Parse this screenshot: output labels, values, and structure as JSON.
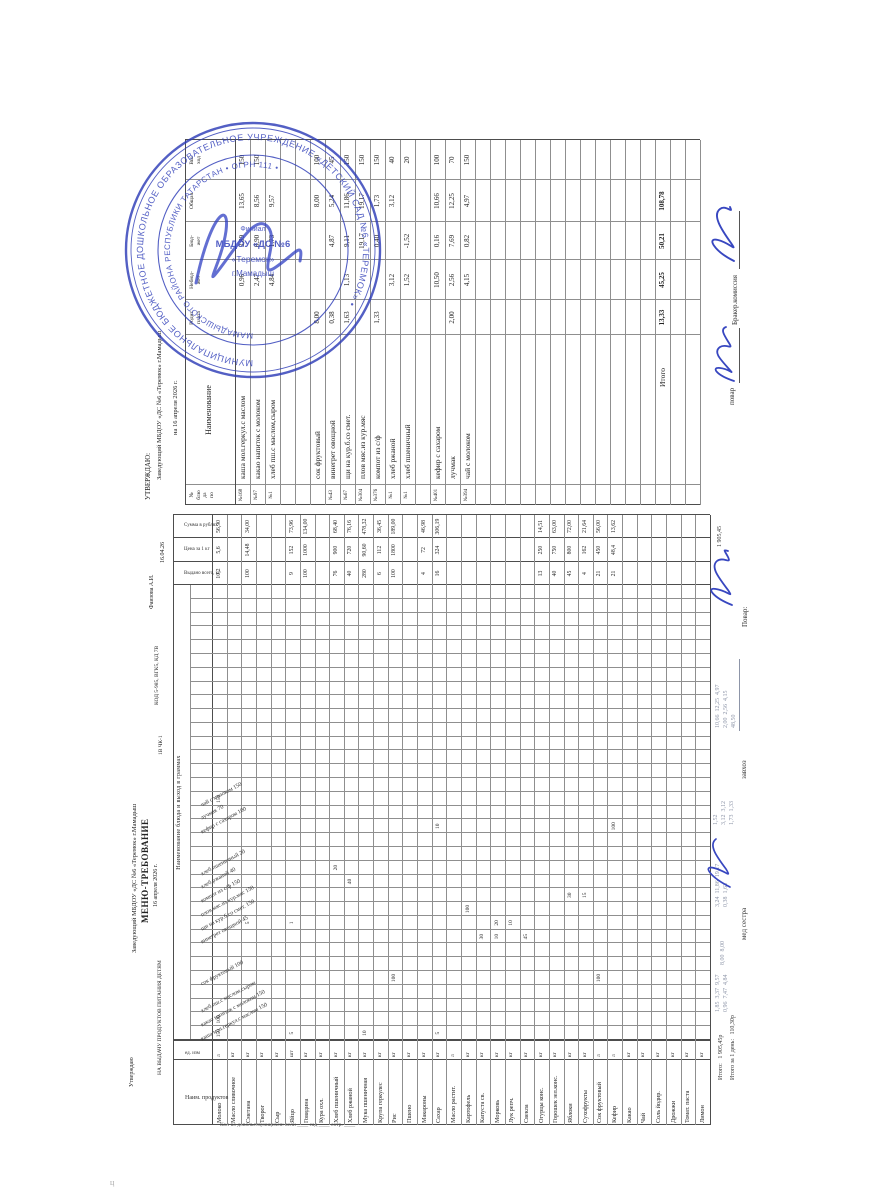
{
  "top_page": {
    "approve_title": "УТВЕРЖДАЮ:",
    "approve_org": "Заведующий МБДОУ «ДС №6 «Теремок» г.Мамадыш",
    "approve_date": "на 16 апреля 2026 г.",
    "table": {
      "headers": {
        "num": "№\nблю\nда\nпо",
        "name": "Наименование",
        "c1": "Родит.\nплата",
        "c2": "Небюд-\nжет",
        "c3": "Бюд-\nжет",
        "c4": "Общая",
        "out": "Вы-\nход"
      },
      "rows": [
        {
          "r": 1,
          "no": "№168",
          "name": "каша мол.геркул.с маслом",
          "c1": "",
          "c2": "0,96",
          "c3": "3,89",
          "c4": "13,65",
          "out": "150"
        },
        {
          "r": 2,
          "no": "№97",
          "name": "какао напиток с молоком",
          "c1": "",
          "c2": "2,47",
          "c3": "0,90",
          "c4": "8,56",
          "out": "150"
        },
        {
          "r": 3,
          "no": "№1",
          "name": "хлеб пш.с маслом,сыром",
          "c1": "",
          "c2": "4,84",
          "c3": "1,73",
          "c4": "9,57",
          "out": ""
        },
        {
          "r": 6,
          "no": "",
          "name": "сок фруктовый",
          "c1": "8,00",
          "c2": "",
          "c3": "",
          "c4": "8,00",
          "out": "100"
        },
        {
          "r": 7,
          "no": "№43",
          "name": "винегрет овощной",
          "c1": "0,38",
          "c2": "",
          "c3": "4,87",
          "c4": "5,24",
          "out": "45"
        },
        {
          "r": 8,
          "no": "№67",
          "name": "щи на кур.б.со смет.",
          "c1": "1,63",
          "c2": "1,13",
          "c3": "9,11",
          "c4": "11,86",
          "out": "150"
        },
        {
          "r": 9,
          "no": "№304",
          "name": "плов мяс.из кур.мяс",
          "c1": "",
          "c2": "",
          "c3": "19,17",
          "c4": "19,17",
          "out": "150"
        },
        {
          "r": 10,
          "no": "№376",
          "name": "компот из с/ф",
          "c1": "1,33",
          "c2": "",
          "c3": "0,40",
          "c4": "1,73",
          "out": "150"
        },
        {
          "r": 11,
          "no": "№1",
          "name": "хлеб ржаной",
          "c1": "",
          "c2": "3,12",
          "c3": "",
          "c4": "3,12",
          "out": "40"
        },
        {
          "r": 12,
          "no": "№1",
          "name": "хлеб пшеничный",
          "c1": "",
          "c2": "1,52",
          "c3": "-1,52",
          "c4": "",
          "out": "20"
        },
        {
          "r": 14,
          "no": "№401",
          "name": "кефир с сахаром",
          "c1": "",
          "c2": "10,50",
          "c3": "0,16",
          "c4": "10,66",
          "out": "100"
        },
        {
          "r": 15,
          "no": "",
          "name": "лучмак",
          "c1": "2,00",
          "c2": "2,56",
          "c3": "7,69",
          "c4": "12,25",
          "out": "70"
        },
        {
          "r": 16,
          "no": "№394",
          "name": "чай с молоком",
          "c1": "",
          "c2": "4,15",
          "c3": "0,82",
          "c4": "4,97",
          "out": "150"
        }
      ],
      "total": {
        "label": "Итого",
        "c1": "13,33",
        "c2": "45,25",
        "c3": "50,21",
        "c4": "108,78"
      }
    },
    "footer": {
      "cook_label": "повар",
      "commission_label": "Бракер.комиссия"
    }
  },
  "stamp": {
    "outer_ring": "МУНИЦИПАЛЬНОЕ БЮДЖЕТНОЕ ДОШКОЛЬНОЕ ОБРАЗОВАТЕЛЬНОЕ УЧРЕЖДЕНИЕ «ДЕТСКИЙ САД №6 «ТЕРЕМОК» • ",
    "inner_ring": "МАМАДЫШСКОГО РАЙОНА РЕСПУБЛИКИ ТАТАРСТАН • ОГРН 111 • ",
    "center_lines": [
      "Филиал",
      "МБДОУ «ДС №6",
      "«Теремок»",
      "г.Мамадыш"
    ],
    "color": "#2e3db8"
  },
  "bottom_page": {
    "header": {
      "approve": "Утверждаю",
      "org": "Заведующий МБДОУ «ДС №6 «Теремок» г.Мамадыш",
      "title": "МЕНЮ-ТРЕБОВАНИЕ",
      "date": "16 апреля 2026 г.",
      "subtitle": "НА ВЫДАЧУ ПРОДУКТОВ ПИТАНИЯ ДЕТЯМ",
      "codes": "КОД 5-985, ВГК5, КД 7В",
      "codes2": "1В ЧК-1",
      "person": "Фаизова А.И.",
      "date_short": "16.04.26"
    },
    "margin_note": "Кол-во довольствующихся: ясли ____  сад ____  сотр. ____",
    "table": {
      "group_header": "Наименование блюда и выход в граммах",
      "products_header": "Наим. продуктов",
      "unit_header": "ед. изм",
      "given_header": "Выдано всего, кг",
      "price_header": "Цена за 1 кг",
      "sum_header": "Сумма в рублях",
      "dishes": [
        {
          "col": 0,
          "label": "каша мол.геркул.с маслом 150"
        },
        {
          "col": 1,
          "label": "какао напиток с молоком 150"
        },
        {
          "col": 2,
          "label": "хлеб пш.с маслом,сыром"
        },
        {
          "col": 4,
          "label": "сок фруктовый 100"
        },
        {
          "col": 7,
          "label": "винегрет овощной 45"
        },
        {
          "col": 8,
          "label": "щи на кур.б.со смет. 150"
        },
        {
          "col": 9,
          "label": "плов мяс.из кур.мяс 150"
        },
        {
          "col": 10,
          "label": "компот из с/ф 150"
        },
        {
          "col": 11,
          "label": "хлеб ржаной 40"
        },
        {
          "col": 12,
          "label": "хлеб пшеничный 20"
        },
        {
          "col": 15,
          "label": "кефир с сахаром 100"
        },
        {
          "col": 16,
          "label": "лучмак 70"
        },
        {
          "col": 17,
          "label": "чай с молоком 150"
        }
      ],
      "products": [
        {
          "name": "Молоко",
          "unit": "л",
          "given": "10,2",
          "price": "5,6",
          "sum": "56,90"
        },
        {
          "name": "Масло сливочное",
          "unit": "кг",
          "given": "",
          "price": "",
          "sum": ""
        },
        {
          "name": "Сметана",
          "unit": "кг",
          "given": "100",
          "price": "14,48",
          "sum": "34,00"
        },
        {
          "name": "Творог",
          "unit": "кг",
          "given": "",
          "price": "",
          "sum": ""
        },
        {
          "name": "Сыр",
          "unit": "кг",
          "given": "",
          "price": "",
          "sum": ""
        },
        {
          "name": "Яйцо",
          "unit": "шт",
          "given": "9",
          "price": "152",
          "sum": "73,96"
        },
        {
          "name": "Говядина",
          "unit": "кг",
          "given": "100",
          "price": "1000",
          "sum": "134,00"
        },
        {
          "name": "Кура охл.",
          "unit": "кг",
          "given": "",
          "price": "",
          "sum": ""
        },
        {
          "name": "Хлеб пшеничный",
          "unit": "кг",
          "given": "76",
          "price": "900",
          "sum": "68,40"
        },
        {
          "name": "Хлеб ржаной",
          "unit": "кг",
          "given": "40",
          "price": "720",
          "sum": "76,16"
        },
        {
          "name": "Мука пшеничная",
          "unit": "кг",
          "given": "280",
          "price": "90,60",
          "sum": "478,32"
        },
        {
          "name": "Крупа геркулес",
          "unit": "кг",
          "given": "6",
          "price": "112",
          "sum": "36,45"
        },
        {
          "name": "Рис",
          "unit": "кг",
          "given": "100",
          "price": "1800",
          "sum": "189,00"
        },
        {
          "name": "Пшено",
          "unit": "кг",
          "given": "",
          "price": "",
          "sum": ""
        },
        {
          "name": "Макароны",
          "unit": "кг",
          "given": "4",
          "price": "72",
          "sum": "46,98"
        },
        {
          "name": "Сахар",
          "unit": "кг",
          "given": "16",
          "price": "324",
          "sum": "306,19"
        },
        {
          "name": "Масло растит.",
          "unit": "л",
          "given": "",
          "price": "",
          "sum": ""
        },
        {
          "name": "Картофель",
          "unit": "кг",
          "given": "",
          "price": "",
          "sum": ""
        },
        {
          "name": "Капуста св.",
          "unit": "кг",
          "given": "",
          "price": "",
          "sum": ""
        },
        {
          "name": "Морковь",
          "unit": "кг",
          "given": "",
          "price": "",
          "sum": ""
        },
        {
          "name": "Лук репч.",
          "unit": "кг",
          "given": "",
          "price": "",
          "sum": ""
        },
        {
          "name": "Свекла",
          "unit": "кг",
          "given": "",
          "price": "",
          "sum": ""
        },
        {
          "name": "Огурцы конс.",
          "unit": "кг",
          "given": "13",
          "price": "250",
          "sum": "14,51"
        },
        {
          "name": "Горошек зел.конс.",
          "unit": "кг",
          "given": "40",
          "price": "750",
          "sum": "63,00"
        },
        {
          "name": "Яблоки",
          "unit": "кг",
          "given": "45",
          "price": "800",
          "sum": "72,00"
        },
        {
          "name": "Сухофрукты",
          "unit": "кг",
          "given": "4",
          "price": "162",
          "sum": "21,64"
        },
        {
          "name": "Сок фруктовый",
          "unit": "л",
          "given": "21",
          "price": "450",
          "sum": "56,00"
        },
        {
          "name": "Кефир",
          "unit": "л",
          "given": "21",
          "price": "48,4",
          "sum": "13,62"
        },
        {
          "name": "Какао",
          "unit": "кг",
          "given": "",
          "price": "",
          "sum": ""
        },
        {
          "name": "Чай",
          "unit": "кг",
          "given": "",
          "price": "",
          "sum": ""
        },
        {
          "name": "Соль йодир.",
          "unit": "кг",
          "given": "",
          "price": "",
          "sum": ""
        },
        {
          "name": "Дрожжи",
          "unit": "кг",
          "given": "",
          "price": "",
          "sum": ""
        },
        {
          "name": "Томат. паста",
          "unit": "кг",
          "given": "",
          "price": "",
          "sum": ""
        },
        {
          "name": "Лимон",
          "unit": "кг",
          "given": "",
          "price": "",
          "sum": ""
        }
      ],
      "cells": [
        [
          0,
          0,
          "150"
        ],
        [
          0,
          1,
          "100"
        ],
        [
          0,
          17,
          "150"
        ],
        [
          2,
          8,
          "5"
        ],
        [
          5,
          0,
          "5"
        ],
        [
          5,
          8,
          "1"
        ],
        [
          8,
          12,
          "20"
        ],
        [
          9,
          11,
          "40"
        ],
        [
          10,
          0,
          "10"
        ],
        [
          12,
          4,
          "100"
        ],
        [
          15,
          0,
          "5"
        ],
        [
          15,
          15,
          "10"
        ],
        [
          17,
          9,
          "100"
        ],
        [
          18,
          7,
          "30"
        ],
        [
          19,
          7,
          "10"
        ],
        [
          19,
          8,
          "20"
        ],
        [
          20,
          8,
          "10"
        ],
        [
          21,
          7,
          "45"
        ],
        [
          24,
          10,
          "30"
        ],
        [
          25,
          10,
          "15"
        ],
        [
          26,
          4,
          "100"
        ],
        [
          27,
          15,
          "100"
        ]
      ]
    },
    "annotations": {
      "totals_label": "Итого:",
      "totals_value": "1 905,45р",
      "per_day_label": "Итого за 1 день:",
      "per_day_value": "110,30р",
      "cook_label": "Повар:",
      "cook_total": "1 905,45",
      "zavhoz_label": "завхоз",
      "medsestra_label": "мед сестра",
      "pencil_breakfast": [
        "1,85  3,37  9,57",
        "0,96  7,47  4,84"
      ],
      "pencil_juice": "8,00  8,00",
      "pencil_lunch": [
        "3,24  11,86  19,17",
        "0,38  1,63"
      ],
      "pencil_zavhoz": [
        "1,52",
        "3,12  3,12",
        "1,73  1,33"
      ],
      "pencil_cook": [
        "10,66  12,25  4,97",
        "2,00  2,56  4,15",
        "48,50"
      ]
    }
  }
}
